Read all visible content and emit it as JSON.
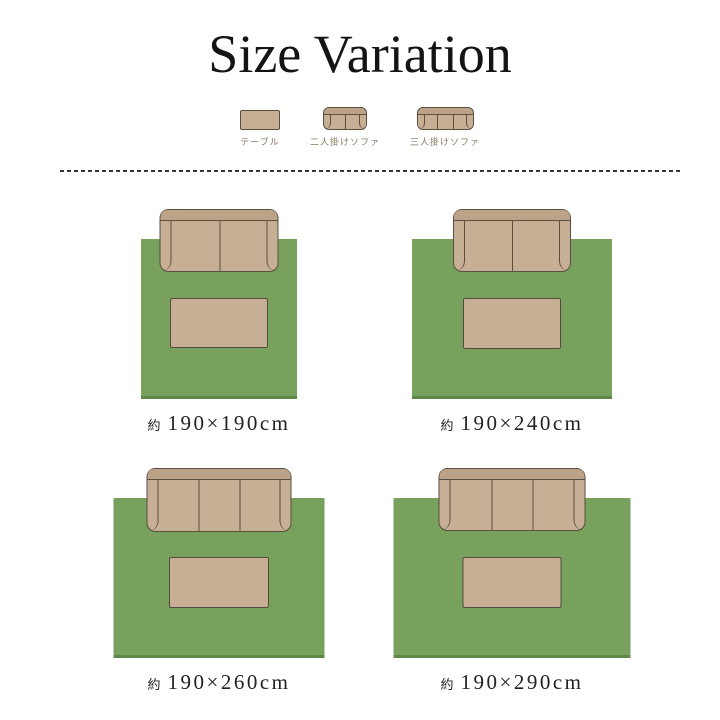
{
  "title": "Size Variation",
  "legend": [
    {
      "label": "テーブル"
    },
    {
      "label": "二人掛けソファ"
    },
    {
      "label": "三人掛けソファ"
    }
  ],
  "diagrams": [
    {
      "approx": "約",
      "size": "190×190cm",
      "sofa_type": "two-seat"
    },
    {
      "approx": "約",
      "size": "190×240cm",
      "sofa_type": "two-seat"
    },
    {
      "approx": "約",
      "size": "190×260cm",
      "sofa_type": "three-seat"
    },
    {
      "approx": "約",
      "size": "190×290cm",
      "sofa_type": "three-seat"
    }
  ],
  "colors": {
    "rug_green": "#77a15c",
    "rug_edge_green": "#5f8948",
    "furniture_fill": "#c6af95",
    "backrest_fill": "#bca387",
    "outline": "#5a4f3f",
    "legend_text": "#8d7b63",
    "label_text": "#222222",
    "divider": "#333333"
  }
}
